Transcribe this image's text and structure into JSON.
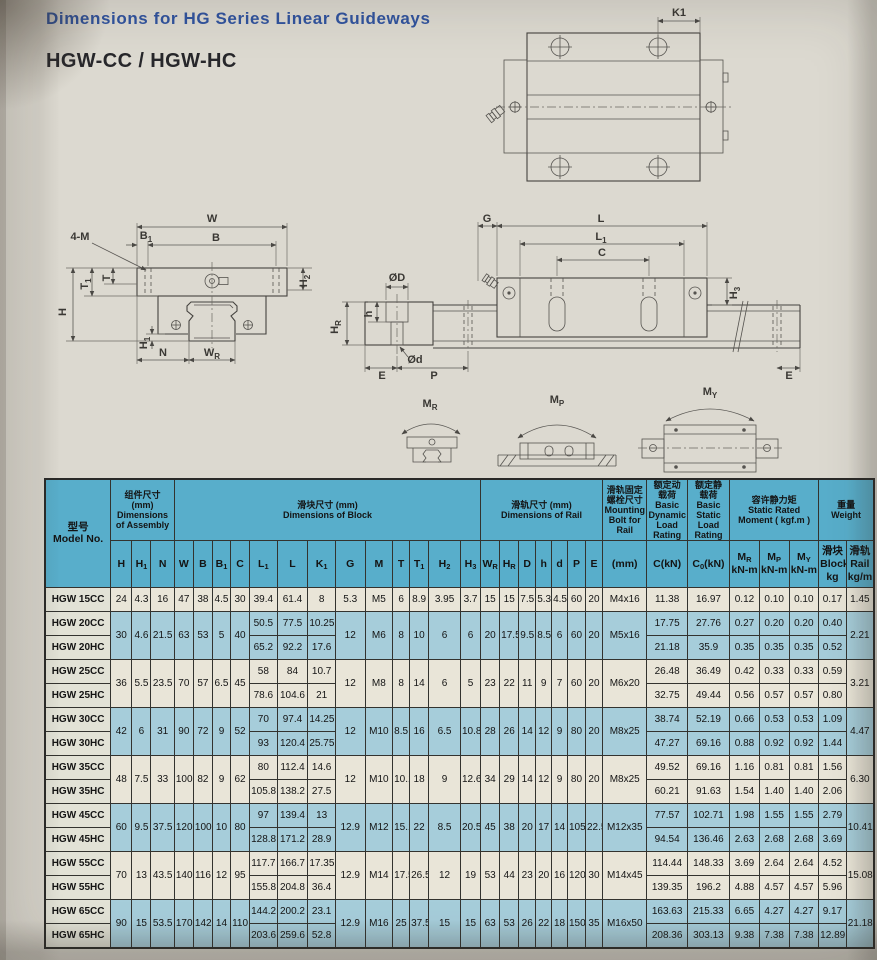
{
  "page": {
    "title": "Dimensions for HG Series Linear Guideways",
    "subtitle": "HGW-CC / HGW-HC"
  },
  "colors": {
    "title_blue": "#31549e",
    "header_blue": "#58aecb",
    "row_blue": "#a6cdda",
    "row_cream": "#e9e5d8"
  },
  "diagrams": {
    "labels": [
      {
        "t": "K1",
        "x": 679,
        "y": 16
      },
      {
        "t": "W",
        "x": 212,
        "y": 222
      },
      {
        "t": "B_1",
        "x": 146,
        "y": 239
      },
      {
        "t": "B",
        "x": 216,
        "y": 241
      },
      {
        "t": "4-M",
        "x": 80,
        "y": 240
      },
      {
        "t": "T_1",
        "x": 88,
        "y": 284,
        "r": -90
      },
      {
        "t": "T",
        "x": 110,
        "y": 278,
        "r": -90
      },
      {
        "t": "H",
        "x": 66,
        "y": 312,
        "r": -90
      },
      {
        "t": "H_1",
        "x": 147,
        "y": 343,
        "r": -90
      },
      {
        "t": "N",
        "x": 163,
        "y": 356
      },
      {
        "t": "W_R",
        "x": 212,
        "y": 356
      },
      {
        "t": "H_2",
        "x": 307,
        "y": 281,
        "r": -90
      },
      {
        "t": "ØD",
        "x": 397,
        "y": 281
      },
      {
        "t": "h",
        "x": 372,
        "y": 314,
        "r": -90
      },
      {
        "t": "H_R",
        "x": 338,
        "y": 327,
        "r": -90
      },
      {
        "t": "Ød",
        "x": 415,
        "y": 363
      },
      {
        "t": "E",
        "x": 382,
        "y": 379
      },
      {
        "t": "P",
        "x": 434,
        "y": 379
      },
      {
        "t": "G",
        "x": 487,
        "y": 222
      },
      {
        "t": "L",
        "x": 601,
        "y": 222
      },
      {
        "t": "L_1",
        "x": 601,
        "y": 240
      },
      {
        "t": "C",
        "x": 602,
        "y": 256
      },
      {
        "t": "H_3",
        "x": 737,
        "y": 293,
        "r": -90
      },
      {
        "t": "E",
        "x": 789,
        "y": 379
      },
      {
        "t": "M_R",
        "x": 430,
        "y": 407
      },
      {
        "t": "M_P",
        "x": 557,
        "y": 403
      },
      {
        "t": "M_Y",
        "x": 710,
        "y": 395
      }
    ]
  },
  "table": {
    "model_header": "型号\nModel No.",
    "groups": [
      {
        "label": "组件尺寸\n(mm)\nDimensions\nof Assembly",
        "span": 3
      },
      {
        "label": "滑块尺寸 (mm)\nDimensions of Block",
        "span": 13
      },
      {
        "label": "滑轨尺寸 (mm)\nDimensions of Rail",
        "span": 7
      },
      {
        "label": "滑轨固定\n螺栓尺寸\nMounting\nBolt for\nRail",
        "span": 1
      },
      {
        "label": "额定动\n载荷\nBasic\nDynamic\nLoad\nRating",
        "span": 1
      },
      {
        "label": "额定静\n载荷\nBasic\nStatic\nLoad\nRating",
        "span": 1
      },
      {
        "label": "容许静力矩\nStatic Rated\nMoment ( kgf.m )",
        "span": 3
      },
      {
        "label": "重量\nWeight",
        "span": 2
      }
    ],
    "sub_headers": [
      "H",
      "H_1",
      "N",
      "W",
      "B",
      "B_1",
      "C",
      "L_1",
      "L",
      "K_1",
      "G",
      "M",
      "T",
      "T_1",
      "H_2",
      "H_3",
      "W_R",
      "H_R",
      "D",
      "h",
      "d",
      "P",
      "E",
      "(mm)",
      "C(kN)",
      "C_0(kN)",
      "M_R\nkN-m",
      "M_P\nkN-m",
      "M_Y\nkN-m",
      "滑块\nBlock\nkg",
      "滑轨\nRail\nkg/m"
    ],
    "col_widths": [
      62,
      20,
      18,
      22,
      18,
      18,
      17,
      18,
      26,
      29,
      26,
      28,
      26,
      16,
      18,
      30,
      19,
      18,
      18,
      16,
      15,
      15,
      17,
      16,
      42,
      38,
      40,
      28,
      28,
      28,
      26,
      26
    ],
    "rows": [
      {
        "model": "HGW 15CC",
        "shade": "c",
        "cells": [
          "24",
          "4.3",
          "16",
          "47",
          "38",
          "4.5",
          "30",
          "39.4",
          "61.4",
          "8",
          "5.3",
          "M5",
          "6",
          "8.9",
          "3.95",
          "3.7",
          "15",
          "15",
          "7.5",
          "5.3",
          "4.5",
          "60",
          "20",
          "M4x16",
          "11.38",
          "16.97",
          "0.12",
          "0.10",
          "0.10",
          "0.17",
          "1.45"
        ]
      },
      {
        "model": "HGW 20CC",
        "shade": "b",
        "cells": [
          [
            "30",
            2
          ],
          [
            "4.6",
            2
          ],
          [
            "21.5",
            2
          ],
          [
            "63",
            2
          ],
          [
            "53",
            2
          ],
          [
            "5",
            2
          ],
          [
            "40",
            2
          ],
          "50.5",
          "77.5",
          "10.25",
          [
            "12",
            2
          ],
          [
            "M6",
            2
          ],
          [
            "8",
            2
          ],
          [
            "10",
            2
          ],
          [
            "6",
            2
          ],
          [
            "6",
            2
          ],
          [
            "20",
            2
          ],
          [
            "17.5",
            2
          ],
          [
            "9.5",
            2
          ],
          [
            "8.5",
            2
          ],
          [
            "6",
            2
          ],
          [
            "60",
            2
          ],
          [
            "20",
            2
          ],
          [
            "M5x16",
            2
          ],
          "17.75",
          "27.76",
          "0.27",
          "0.20",
          "0.20",
          "0.40",
          [
            "2.21",
            2
          ]
        ]
      },
      {
        "model": "HGW 20HC",
        "shade": "b",
        "cells": [
          "65.2",
          "92.2",
          "17.6",
          "21.18",
          "35.9",
          "0.35",
          "0.35",
          "0.35",
          "0.52"
        ]
      },
      {
        "model": "HGW 25CC",
        "shade": "c",
        "cells": [
          [
            "36",
            2
          ],
          [
            "5.5",
            2
          ],
          [
            "23.5",
            2
          ],
          [
            "70",
            2
          ],
          [
            "57",
            2
          ],
          [
            "6.5",
            2
          ],
          [
            "45",
            2
          ],
          "58",
          "84",
          "10.7",
          [
            "12",
            2
          ],
          [
            "M8",
            2
          ],
          [
            "8",
            2
          ],
          [
            "14",
            2
          ],
          [
            "6",
            2
          ],
          [
            "5",
            2
          ],
          [
            "23",
            2
          ],
          [
            "22",
            2
          ],
          [
            "11",
            2
          ],
          [
            "9",
            2
          ],
          [
            "7",
            2
          ],
          [
            "60",
            2
          ],
          [
            "20",
            2
          ],
          [
            "M6x20",
            2
          ],
          "26.48",
          "36.49",
          "0.42",
          "0.33",
          "0.33",
          "0.59",
          [
            "3.21",
            2
          ]
        ]
      },
      {
        "model": "HGW 25HC",
        "shade": "c",
        "cells": [
          "78.6",
          "104.6",
          "21",
          "32.75",
          "49.44",
          "0.56",
          "0.57",
          "0.57",
          "0.80"
        ]
      },
      {
        "model": "HGW 30CC",
        "shade": "b",
        "cells": [
          [
            "42",
            2
          ],
          [
            "6",
            2
          ],
          [
            "31",
            2
          ],
          [
            "90",
            2
          ],
          [
            "72",
            2
          ],
          [
            "9",
            2
          ],
          [
            "52",
            2
          ],
          "70",
          "97.4",
          "14.25",
          [
            "12",
            2
          ],
          [
            "M10",
            2
          ],
          [
            "8.5",
            2
          ],
          [
            "16",
            2
          ],
          [
            "6.5",
            2
          ],
          [
            "10.8",
            2
          ],
          [
            "28",
            2
          ],
          [
            "26",
            2
          ],
          [
            "14",
            2
          ],
          [
            "12",
            2
          ],
          [
            "9",
            2
          ],
          [
            "80",
            2
          ],
          [
            "20",
            2
          ],
          [
            "M8x25",
            2
          ],
          "38.74",
          "52.19",
          "0.66",
          "0.53",
          "0.53",
          "1.09",
          [
            "4.47",
            2
          ]
        ]
      },
      {
        "model": "HGW 30HC",
        "shade": "b",
        "cells": [
          "93",
          "120.4",
          "25.75",
          "47.27",
          "69.16",
          "0.88",
          "0.92",
          "0.92",
          "1.44"
        ]
      },
      {
        "model": "HGW 35CC",
        "shade": "c",
        "cells": [
          [
            "48",
            2
          ],
          [
            "7.5",
            2
          ],
          [
            "33",
            2
          ],
          [
            "100",
            2
          ],
          [
            "82",
            2
          ],
          [
            "9",
            2
          ],
          [
            "62",
            2
          ],
          "80",
          "112.4",
          "14.6",
          [
            "12",
            2
          ],
          [
            "M10",
            2
          ],
          [
            "10.1",
            2
          ],
          [
            "18",
            2
          ],
          [
            "9",
            2
          ],
          [
            "12.6",
            2
          ],
          [
            "34",
            2
          ],
          [
            "29",
            2
          ],
          [
            "14",
            2
          ],
          [
            "12",
            2
          ],
          [
            "9",
            2
          ],
          [
            "80",
            2
          ],
          [
            "20",
            2
          ],
          [
            "M8x25",
            2
          ],
          "49.52",
          "69.16",
          "1.16",
          "0.81",
          "0.81",
          "1.56",
          [
            "6.30",
            2
          ]
        ]
      },
      {
        "model": "HGW 35HC",
        "shade": "c",
        "cells": [
          "105.8",
          "138.2",
          "27.5",
          "60.21",
          "91.63",
          "1.54",
          "1.40",
          "1.40",
          "2.06"
        ]
      },
      {
        "model": "HGW 45CC",
        "shade": "b",
        "cells": [
          [
            "60",
            2
          ],
          [
            "9.5",
            2
          ],
          [
            "37.5",
            2
          ],
          [
            "120",
            2
          ],
          [
            "100",
            2
          ],
          [
            "10",
            2
          ],
          [
            "80",
            2
          ],
          "97",
          "139.4",
          "13",
          [
            "12.9",
            2
          ],
          [
            "M12",
            2
          ],
          [
            "15.1",
            2
          ],
          [
            "22",
            2
          ],
          [
            "8.5",
            2
          ],
          [
            "20.5",
            2
          ],
          [
            "45",
            2
          ],
          [
            "38",
            2
          ],
          [
            "20",
            2
          ],
          [
            "17",
            2
          ],
          [
            "14",
            2
          ],
          [
            "105",
            2
          ],
          [
            "22.5",
            2
          ],
          [
            "M12x35",
            2
          ],
          "77.57",
          "102.71",
          "1.98",
          "1.55",
          "1.55",
          "2.79",
          [
            "10.41",
            2
          ]
        ]
      },
      {
        "model": "HGW 45HC",
        "shade": "b",
        "cells": [
          "128.8",
          "171.2",
          "28.9",
          "94.54",
          "136.46",
          "2.63",
          "2.68",
          "2.68",
          "3.69"
        ]
      },
      {
        "model": "HGW 55CC",
        "shade": "c",
        "cells": [
          [
            "70",
            2
          ],
          [
            "13",
            2
          ],
          [
            "43.5",
            2
          ],
          [
            "140",
            2
          ],
          [
            "116",
            2
          ],
          [
            "12",
            2
          ],
          [
            "95",
            2
          ],
          "117.7",
          "166.7",
          "17.35",
          [
            "12.9",
            2
          ],
          [
            "M14",
            2
          ],
          [
            "17.5",
            2
          ],
          [
            "26.5",
            2
          ],
          [
            "12",
            2
          ],
          [
            "19",
            2
          ],
          [
            "53",
            2
          ],
          [
            "44",
            2
          ],
          [
            "23",
            2
          ],
          [
            "20",
            2
          ],
          [
            "16",
            2
          ],
          [
            "120",
            2
          ],
          [
            "30",
            2
          ],
          [
            "M14x45",
            2
          ],
          "114.44",
          "148.33",
          "3.69",
          "2.64",
          "2.64",
          "4.52",
          [
            "15.08",
            2
          ]
        ]
      },
      {
        "model": "HGW 55HC",
        "shade": "c",
        "cells": [
          "155.8",
          "204.8",
          "36.4",
          "139.35",
          "196.2",
          "4.88",
          "4.57",
          "4.57",
          "5.96"
        ]
      },
      {
        "model": "HGW 65CC",
        "shade": "b",
        "cells": [
          [
            "90",
            2
          ],
          [
            "15",
            2
          ],
          [
            "53.5",
            2
          ],
          [
            "170",
            2
          ],
          [
            "142",
            2
          ],
          [
            "14",
            2
          ],
          [
            "110",
            2
          ],
          "144.2",
          "200.2",
          "23.1",
          [
            "12.9",
            2
          ],
          [
            "M16",
            2
          ],
          [
            "25",
            2
          ],
          [
            "37.5",
            2
          ],
          [
            "15",
            2
          ],
          [
            "15",
            2
          ],
          [
            "63",
            2
          ],
          [
            "53",
            2
          ],
          [
            "26",
            2
          ],
          [
            "22",
            2
          ],
          [
            "18",
            2
          ],
          [
            "150",
            2
          ],
          [
            "35",
            2
          ],
          [
            "M16x50",
            2
          ],
          "163.63",
          "215.33",
          "6.65",
          "4.27",
          "4.27",
          "9.17",
          [
            "21.18",
            2
          ]
        ]
      },
      {
        "model": "HGW 65HC",
        "shade": "b",
        "cells": [
          "203.6",
          "259.6",
          "52.8",
          "208.36",
          "303.13",
          "9.38",
          "7.38",
          "7.38",
          "12.89"
        ]
      }
    ]
  }
}
